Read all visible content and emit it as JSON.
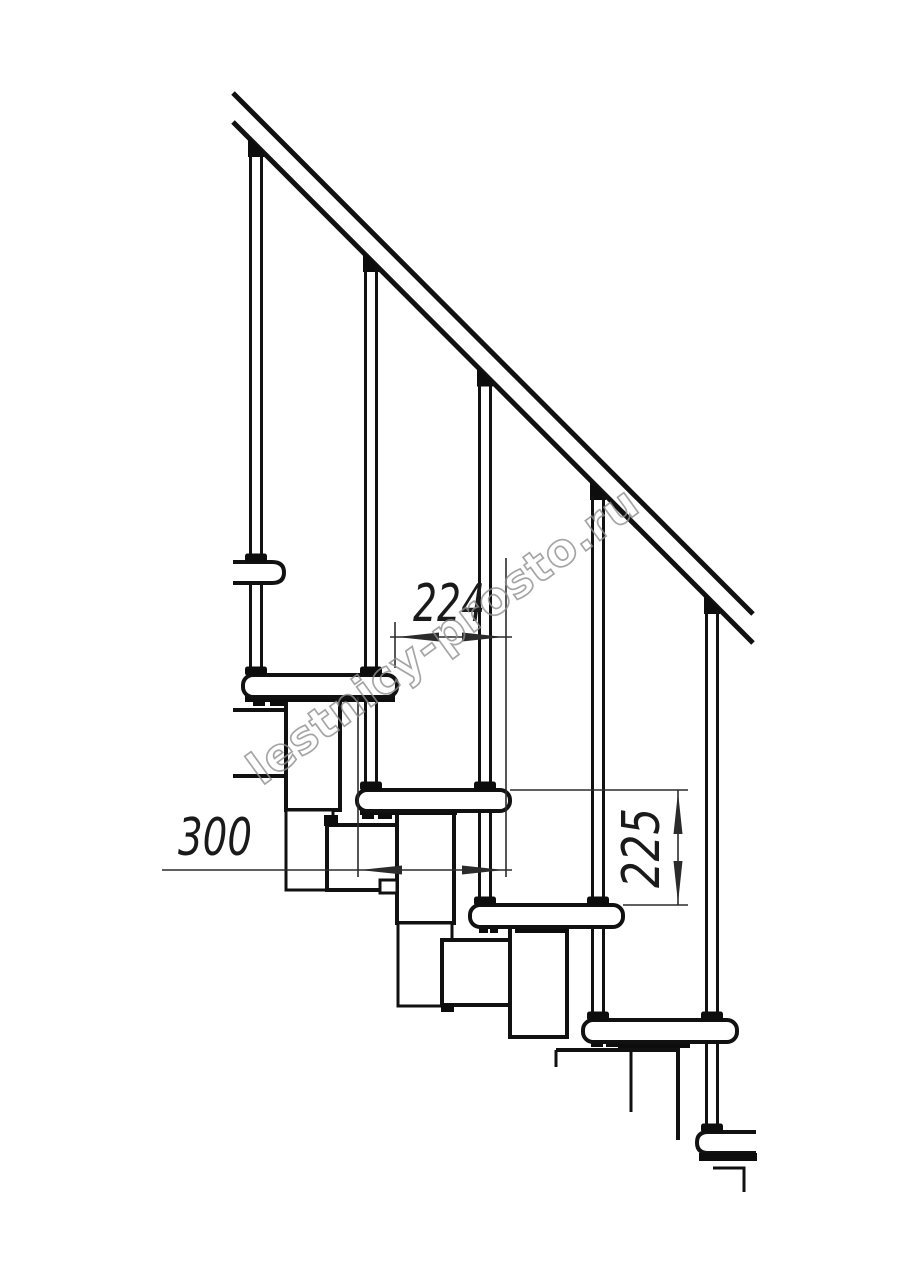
{
  "canvas": {
    "width": 914,
    "height": 1280,
    "background": "#ffffff",
    "line_color": "#111111",
    "dimension_color": "#2b2b2b"
  },
  "watermark": {
    "text": "lestnicy-prosto.ru",
    "color": "#8f8f8f"
  },
  "drawing": {
    "subject": "modular-staircase-side-elevation",
    "dimensions": [
      {
        "id": "step-run",
        "label": "224",
        "orientation": "horizontal"
      },
      {
        "id": "tread-depth",
        "label": "300",
        "orientation": "horizontal"
      },
      {
        "id": "step-rise",
        "label": "225",
        "orientation": "vertical"
      }
    ],
    "baluster_count": 5,
    "tread_count": 6
  }
}
